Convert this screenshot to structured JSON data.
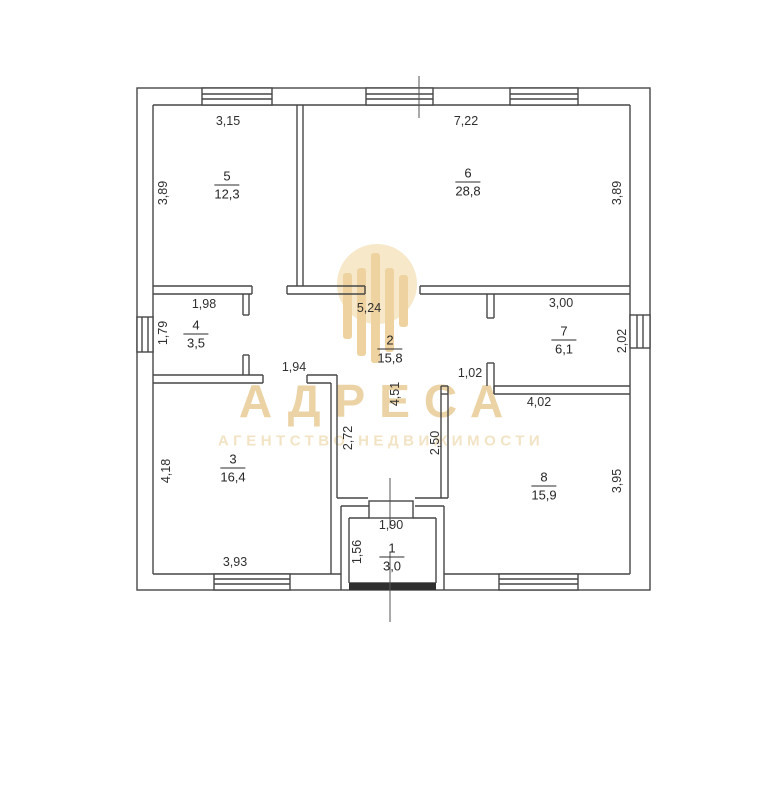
{
  "watermark": {
    "brand": "АДРЕСА",
    "tagline": "АГЕНТСТВО НЕДВИЖИМОСТИ",
    "brand_color": "#e8cc96",
    "tagline_color": "#f1e1bf",
    "logo_circle_color": "#f6e8c8",
    "logo_column_color": "#eed3a0"
  },
  "plan": {
    "line_color": "#474747",
    "rooms": [
      {
        "number": "5",
        "area": "12,3"
      },
      {
        "number": "6",
        "area": "28,8"
      },
      {
        "number": "4",
        "area": "3,5"
      },
      {
        "number": "2",
        "area": "15,8"
      },
      {
        "number": "7",
        "area": "6,1"
      },
      {
        "number": "3",
        "area": "16,4"
      },
      {
        "number": "8",
        "area": "15,9"
      },
      {
        "number": "1",
        "area": "3,0"
      }
    ],
    "dimensions": [
      {
        "text": "3,15"
      },
      {
        "text": "7,22"
      },
      {
        "text": "3,89"
      },
      {
        "text": "3,89"
      },
      {
        "text": "1,98"
      },
      {
        "text": "5,24"
      },
      {
        "text": "3,00"
      },
      {
        "text": "1,79"
      },
      {
        "text": "2,02"
      },
      {
        "text": "1,94"
      },
      {
        "text": "1,02"
      },
      {
        "text": "4,51"
      },
      {
        "text": "4,02"
      },
      {
        "text": "2,72"
      },
      {
        "text": "2,50"
      },
      {
        "text": "4,18"
      },
      {
        "text": "3,95"
      },
      {
        "text": "1,90"
      },
      {
        "text": "1,56"
      },
      {
        "text": "3,93"
      }
    ]
  }
}
